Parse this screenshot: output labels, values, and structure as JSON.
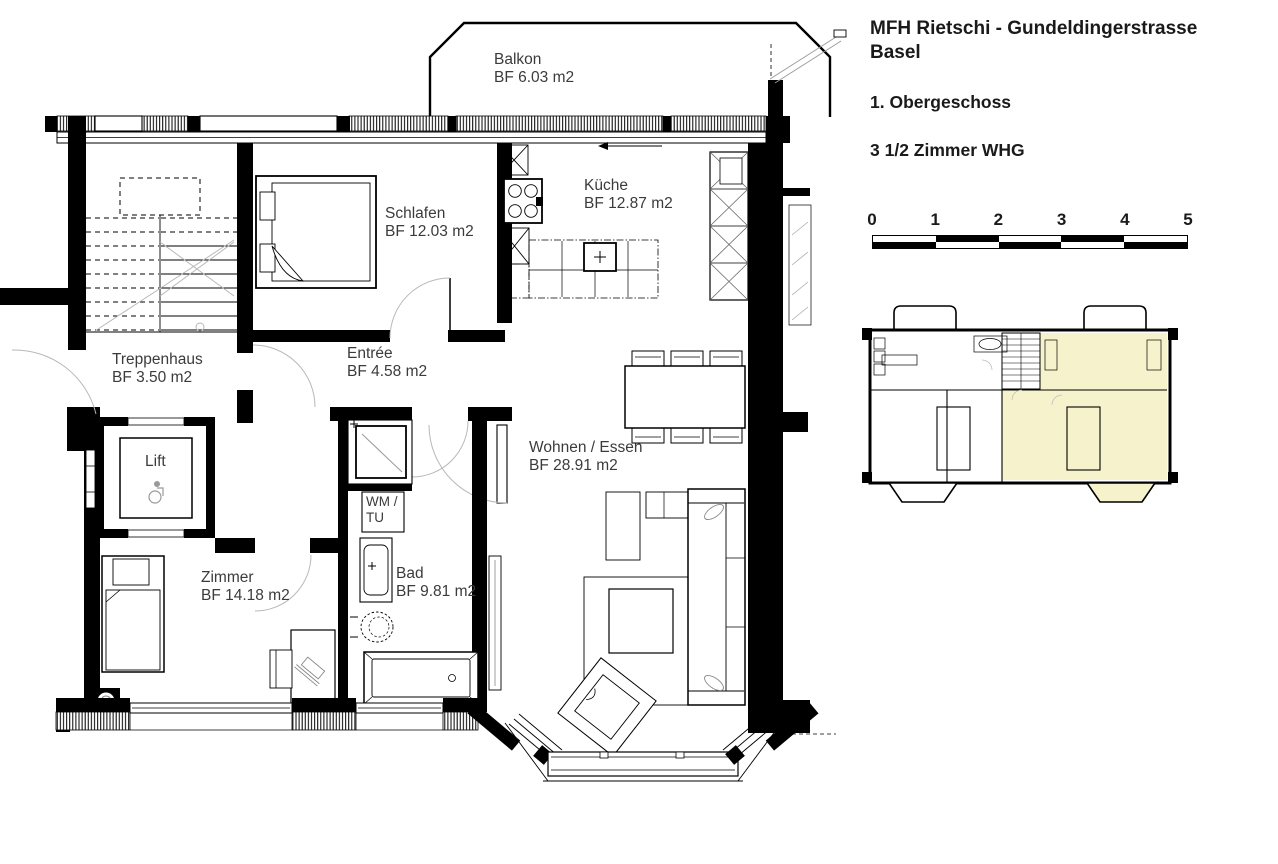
{
  "title": {
    "line1": "MFH Rietschi - Gundeldingerstrasse",
    "line2": "Basel"
  },
  "floor_label": "1. Obergeschoss",
  "apartment_label": "3 1/2 Zimmer WHG",
  "scale": {
    "ticks": [
      "0",
      "1",
      "2",
      "3",
      "4",
      "5"
    ]
  },
  "rooms": {
    "balkon": {
      "name": "Balkon",
      "area": "BF 6.03 m2"
    },
    "schlafen": {
      "name": "Schlafen",
      "area": "BF 12.03 m2"
    },
    "kueche": {
      "name": "Küche",
      "area": "BF 12.87 m2"
    },
    "treppenhaus": {
      "name": "Treppenhaus",
      "area": "BF 3.50 m2"
    },
    "entree": {
      "name": "Entrée",
      "area": "BF 4.58 m2"
    },
    "lift": {
      "name": "Lift"
    },
    "wm_tu": {
      "line1": "WM /",
      "line2": "TU"
    },
    "bad": {
      "name": "Bad",
      "area": "BF 9.81 m2"
    },
    "zimmer": {
      "name": "Zimmer",
      "area": "BF 14.18 m2"
    },
    "wohnen_essen": {
      "name": "Wohnen / Essen",
      "area": "BF 28.91 m2"
    }
  },
  "colors": {
    "highlight": "#F6F3CC",
    "wall": "#000000",
    "text": "#3B3B3B",
    "arc": "#B8B8B8"
  }
}
